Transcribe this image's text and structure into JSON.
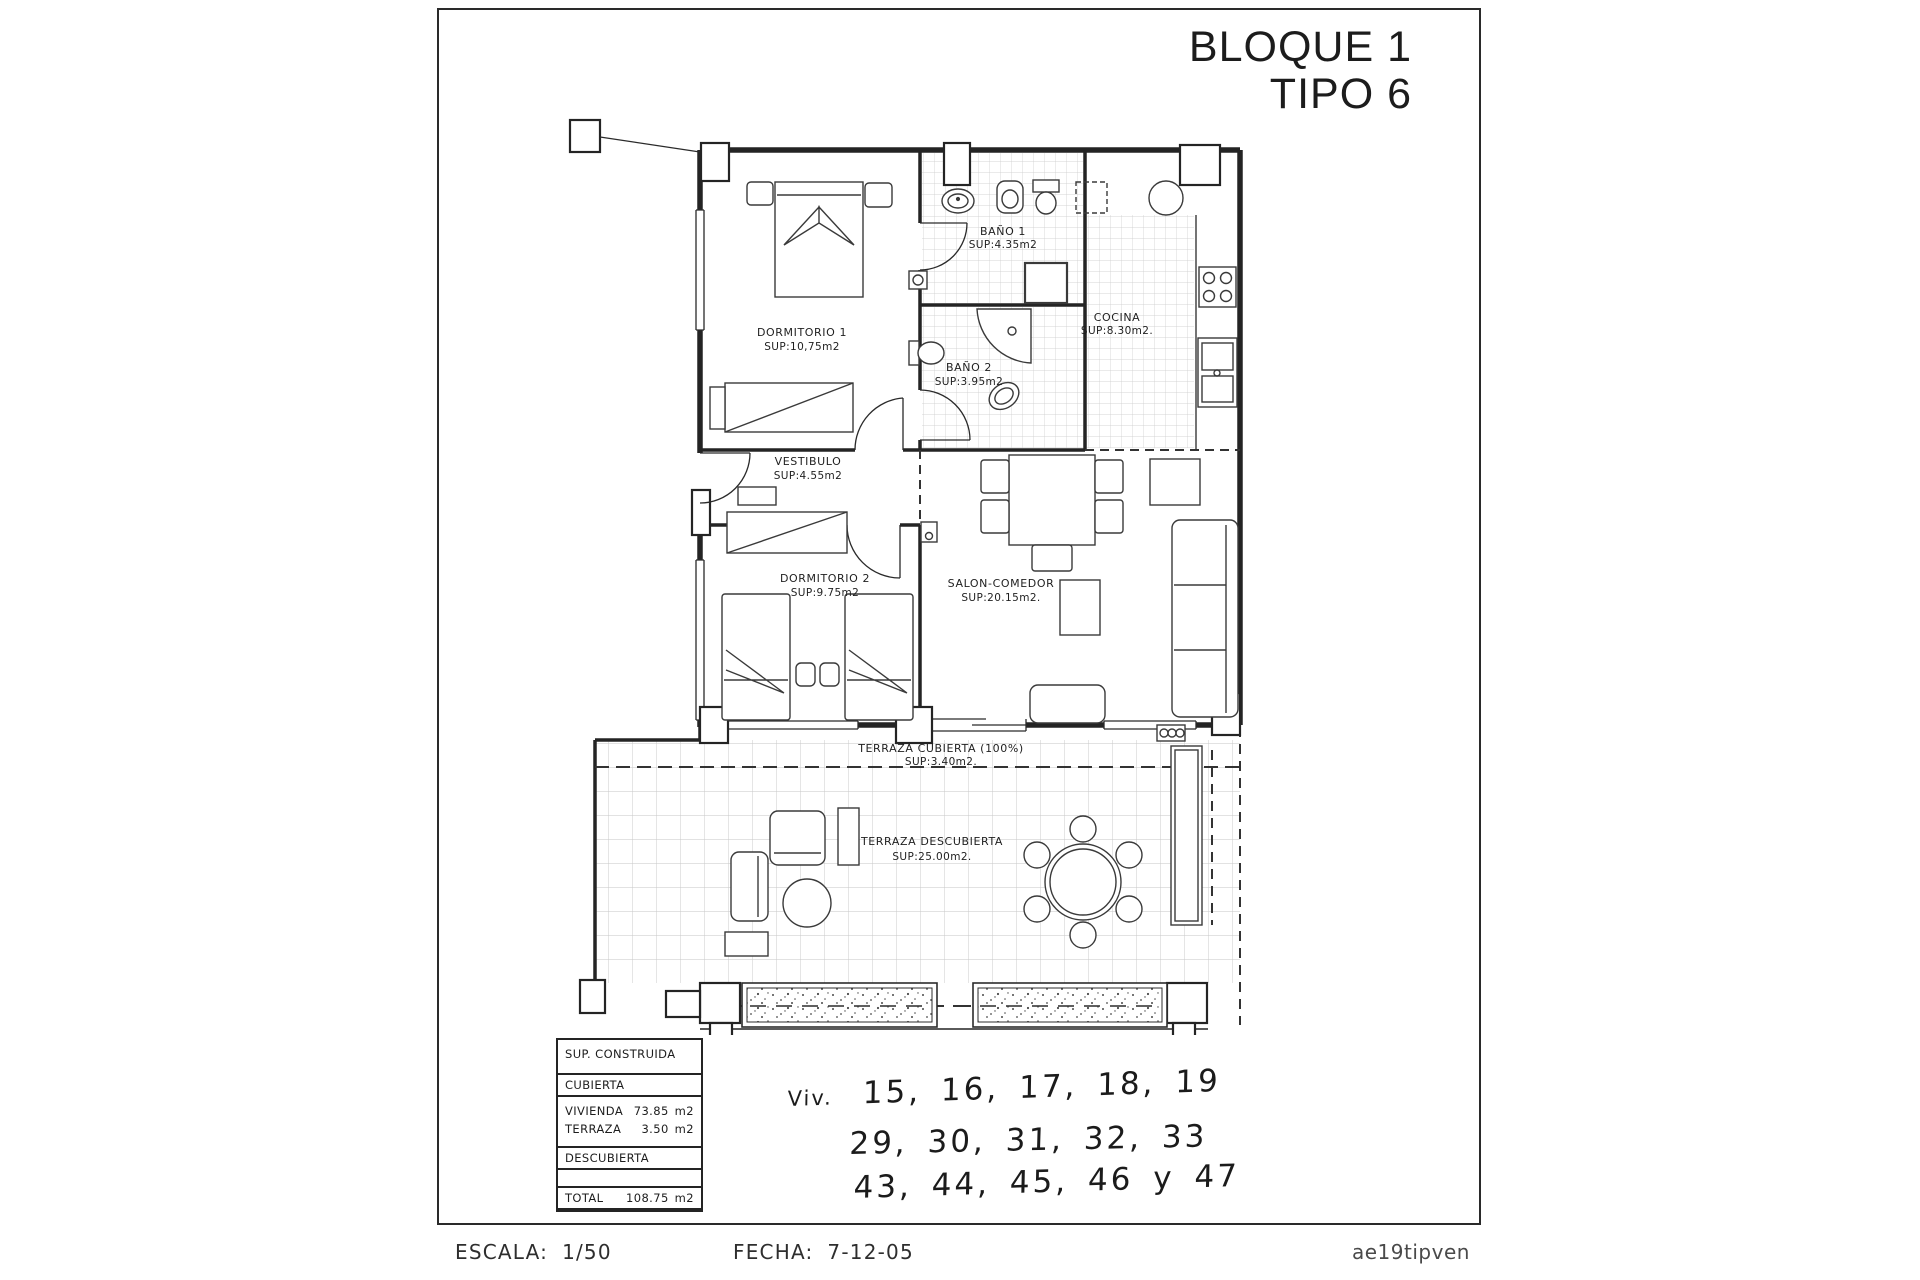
{
  "title": {
    "line1": "BLOQUE 1",
    "line2": "TIPO 6"
  },
  "rooms": [
    {
      "name": "DORMITORIO 1",
      "sup": "SUP:10,75m2"
    },
    {
      "name": "BAÑO 1",
      "sup": "SUP:4.35m2"
    },
    {
      "name": "BAÑO 2",
      "sup": "SUP:3.95m2"
    },
    {
      "name": "COCINA",
      "sup": "SUP:8.30m2."
    },
    {
      "name": "VESTIBULO",
      "sup": "SUP:4.55m2"
    },
    {
      "name": "DORMITORIO 2",
      "sup": "SUP:9.75m2"
    },
    {
      "name": "SALON-COMEDOR",
      "sup": "SUP:20.15m2."
    },
    {
      "name": "TERRAZA CUBIERTA (100%)",
      "sup": "SUP:3.40m2."
    },
    {
      "name": "TERRAZA DESCUBIERTA",
      "sup": "SUP:25.00m2."
    }
  ],
  "area_table": {
    "header": "SUP. CONSTRUIDA",
    "cubierta_title": "CUBIERTA",
    "cubierta_rows": [
      {
        "label": "VIVIENDA",
        "value": "73.85",
        "unit": "m2"
      },
      {
        "label": "TERRAZA",
        "value": "3.50",
        "unit": "m2"
      }
    ],
    "descubierta_title": "DESCUBIERTA",
    "descubierta_rows": [
      {
        "label": "TERRAZA",
        "value": "31.40",
        "unit": "m2"
      }
    ],
    "total": {
      "label": "TOTAL",
      "value": "108.75",
      "unit": "m2"
    }
  },
  "handwritten": {
    "prefix": "Viv.",
    "line1": "15, 16, 17, 18, 19",
    "line2": "29, 30, 31, 32, 33",
    "line3": "43, 44, 45, 46 y 47"
  },
  "footer": {
    "escala_label": "ESCALA:",
    "escala_value": "1/50",
    "fecha_label": "FECHA:",
    "fecha_value": "7-12-05",
    "reference": "ae19tipven"
  }
}
